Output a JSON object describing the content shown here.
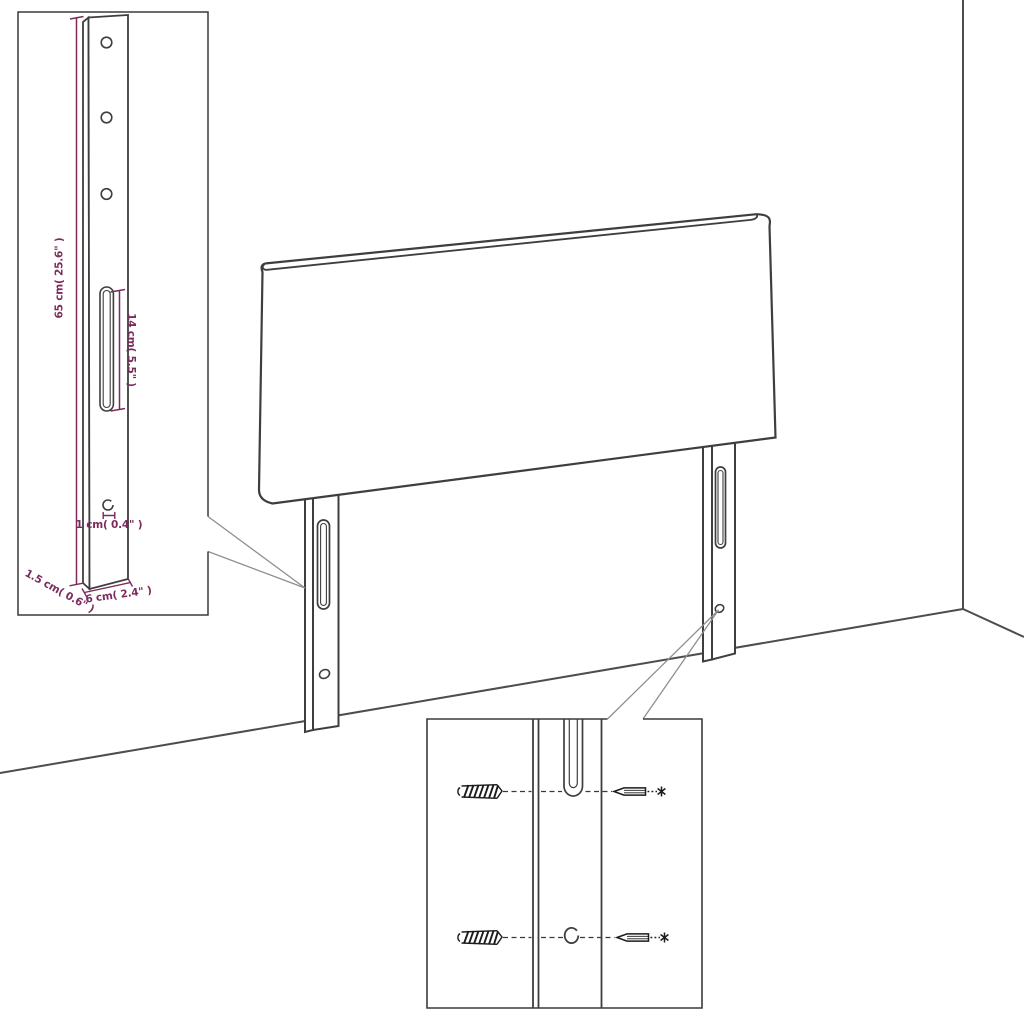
{
  "diagram": {
    "background_color": "#ffffff",
    "line_color": "#3e3e3e",
    "accent_color": "#7c2b5d",
    "callout_color": "#8f8f8f",
    "dimensions": {
      "leg_length": "65 cm( 25.6\" )",
      "slot_length": "14 cm( 5.5\" )",
      "hole_diameter": "1 cm( 0.4\" )",
      "leg_thickness": "1.5 cm( 0.6\" )",
      "leg_width": "6 cm( 2.4\" )"
    },
    "icons": {
      "wall_plug": "wall-plug-icon",
      "screw": "screw-icon"
    }
  }
}
